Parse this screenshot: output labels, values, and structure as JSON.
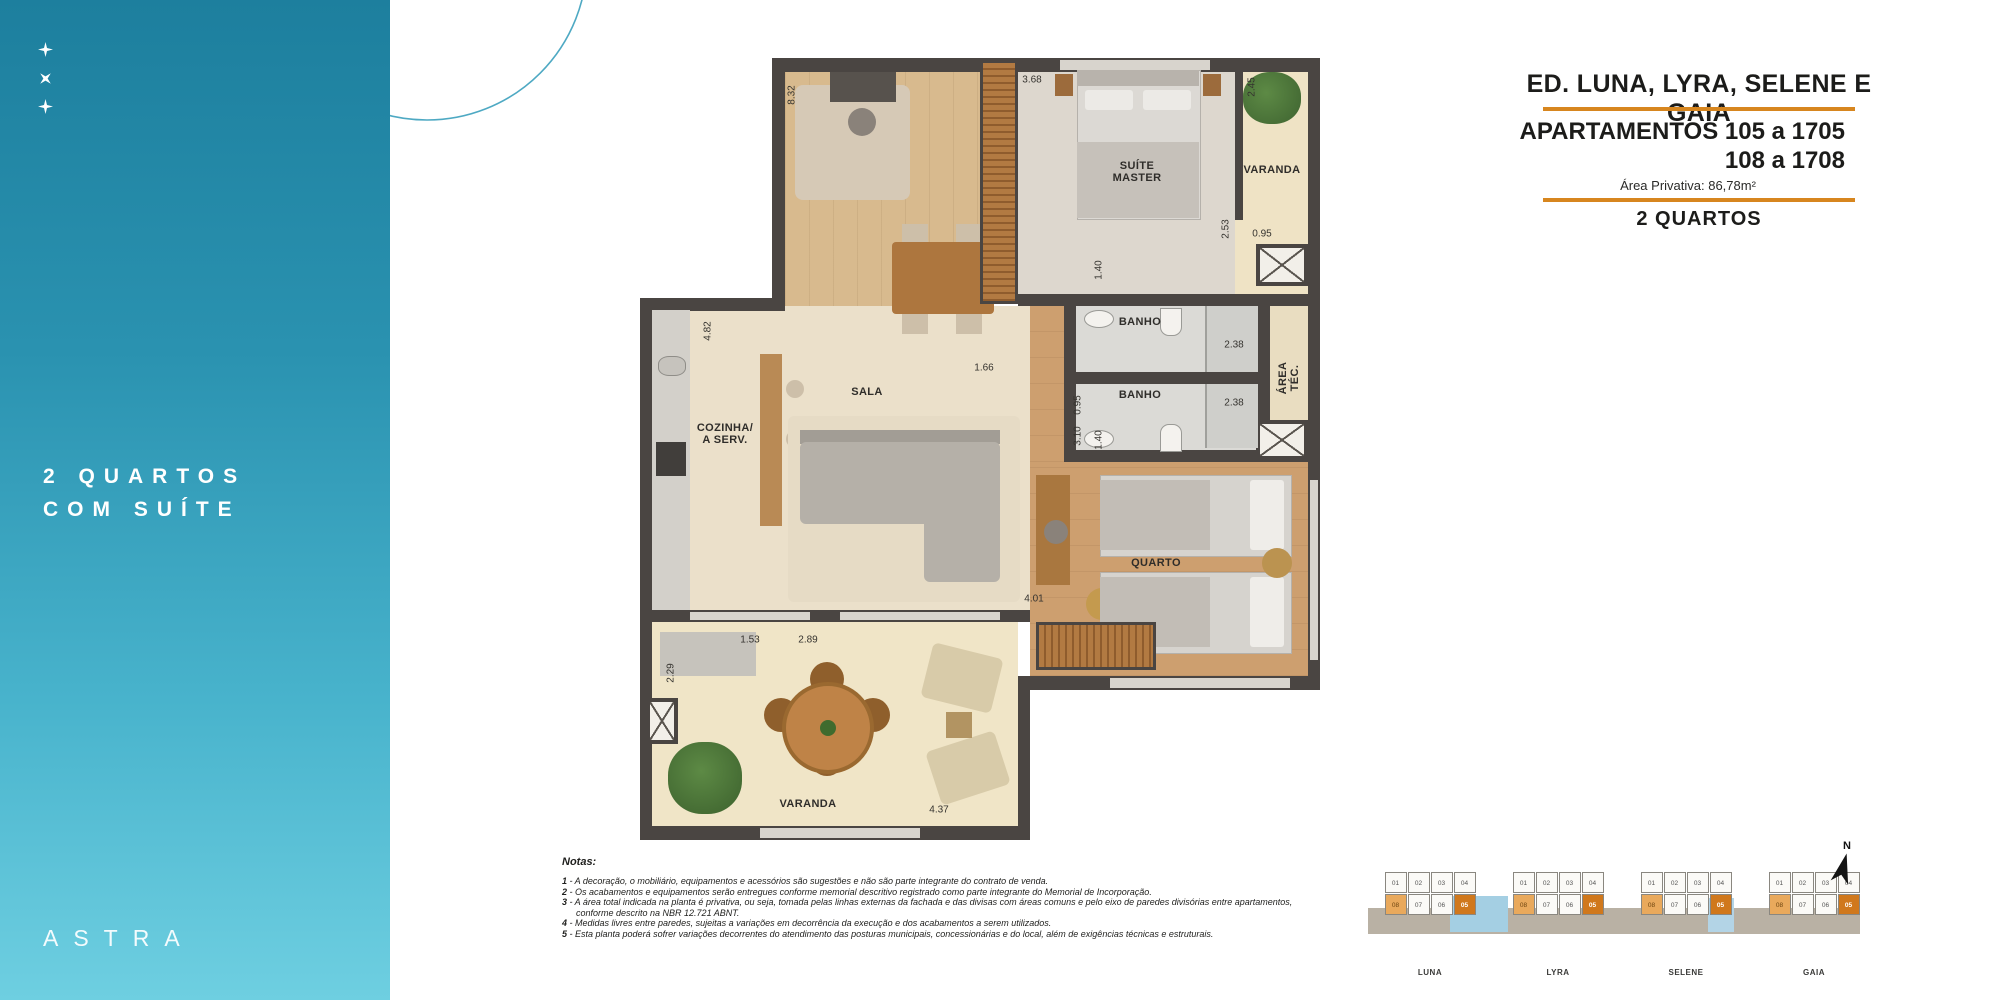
{
  "sidebar": {
    "headline": "2 QUARTOS\nCOM SUÍTE",
    "logo": "ASTRA",
    "colors": {
      "gradient_top": "#1d7f9e",
      "gradient_bottom": "#6ecfe1"
    }
  },
  "title_block": {
    "building_title": "ED. LUNA, LYRA, SELENE E GAIA",
    "apartments_line1": "APARTAMENTOS 105 a 1705",
    "apartments_line2": "108 a 1708",
    "area": "Área Privativa: 86,78m²",
    "type_label": "2 QUARTOS",
    "rule_color": "#d7861f"
  },
  "plan": {
    "room_labels": [
      {
        "text": "SUÍTE\nMASTER",
        "x": 497,
        "y": 122,
        "v": false
      },
      {
        "text": "VARANDA",
        "x": 632,
        "y": 120,
        "v": false
      },
      {
        "text": "ÁREA TÉC.",
        "x": 649,
        "y": 328,
        "v": true
      },
      {
        "text": "BANHO",
        "x": 500,
        "y": 272,
        "v": false
      },
      {
        "text": "BANHO",
        "x": 500,
        "y": 345,
        "v": false
      },
      {
        "text": "SALA",
        "x": 227,
        "y": 342,
        "v": false
      },
      {
        "text": "COZINHA/\nA SERV.",
        "x": 85,
        "y": 384,
        "v": false
      },
      {
        "text": "QUARTO",
        "x": 516,
        "y": 513,
        "v": false
      },
      {
        "text": "VARANDA",
        "x": 168,
        "y": 754,
        "v": false
      }
    ],
    "measurements": [
      {
        "text": "8.32",
        "x": 152,
        "y": 45,
        "v": true
      },
      {
        "text": "3.68",
        "x": 392,
        "y": 30,
        "v": false
      },
      {
        "text": "2.45",
        "x": 612,
        "y": 37,
        "v": true
      },
      {
        "text": "2.53",
        "x": 586,
        "y": 179,
        "v": true
      },
      {
        "text": "0.95",
        "x": 622,
        "y": 184,
        "v": false
      },
      {
        "text": "1.40",
        "x": 459,
        "y": 220,
        "v": true
      },
      {
        "text": "2.38",
        "x": 594,
        "y": 295,
        "v": false
      },
      {
        "text": "2.38",
        "x": 594,
        "y": 353,
        "v": false
      },
      {
        "text": "0.95",
        "x": 438,
        "y": 355,
        "v": true
      },
      {
        "text": "3.10",
        "x": 438,
        "y": 386,
        "v": true
      },
      {
        "text": "1.40",
        "x": 459,
        "y": 390,
        "v": true
      },
      {
        "text": "1.66",
        "x": 344,
        "y": 318,
        "v": false
      },
      {
        "text": "4.82",
        "x": 68,
        "y": 281,
        "v": true
      },
      {
        "text": "4.01",
        "x": 394,
        "y": 549,
        "v": false
      },
      {
        "text": "1.53",
        "x": 110,
        "y": 590,
        "v": false
      },
      {
        "text": "2.89",
        "x": 168,
        "y": 590,
        "v": false
      },
      {
        "text": "2.29",
        "x": 31,
        "y": 623,
        "v": true
      },
      {
        "text": "4.37",
        "x": 299,
        "y": 760,
        "v": false
      }
    ]
  },
  "notes": {
    "title": "Notas:",
    "items": [
      {
        "num": "1",
        "text": "A decoração, o mobiliário, equipamentos e acessórios são sugestões e não são parte integrante do contrato de venda."
      },
      {
        "num": "2",
        "text": "Os acabamentos e equipamentos serão entregues conforme memorial descritivo registrado como parte integrante do Memorial de Incorporação."
      },
      {
        "num": "3",
        "text": "A área total indicada na planta é privativa, ou seja, tomada pelas linhas externas da fachada e das divisas com áreas comuns e pelo eixo de paredes divisórias entre apartamentos, conforme descrito na NBR 12.721 ABNT."
      },
      {
        "num": "4",
        "text": "Medidas livres entre paredes, sujeitas a variações em decorrência da execução e dos acabamentos a serem utilizados."
      },
      {
        "num": "5",
        "text": "Esta planta poderá sofrer variações decorrentes do atendimento das posturas municipais, concessionárias e do local, além de exigências técnicas e estruturais."
      }
    ]
  },
  "keyplan": {
    "buildings": [
      {
        "name": "LUNA",
        "top": [
          "01",
          "02",
          "03",
          "04"
        ],
        "bottom": [
          "08",
          "07",
          "06",
          "05"
        ]
      },
      {
        "name": "LYRA",
        "top": [
          "01",
          "02",
          "03",
          "04"
        ],
        "bottom": [
          "08",
          "07",
          "06",
          "05"
        ]
      },
      {
        "name": "SELENE",
        "top": [
          "01",
          "02",
          "03",
          "04"
        ],
        "bottom": [
          "08",
          "07",
          "06",
          "05"
        ]
      },
      {
        "name": "GAIA",
        "top": [
          "01",
          "02",
          "03",
          "04"
        ],
        "bottom": [
          "08",
          "07",
          "06",
          "05"
        ]
      }
    ],
    "highlight_light": "08",
    "highlight_dark": "05",
    "highlight_colors": {
      "light": "#e9a95c",
      "dark": "#d0781c"
    },
    "north_label": "N"
  }
}
